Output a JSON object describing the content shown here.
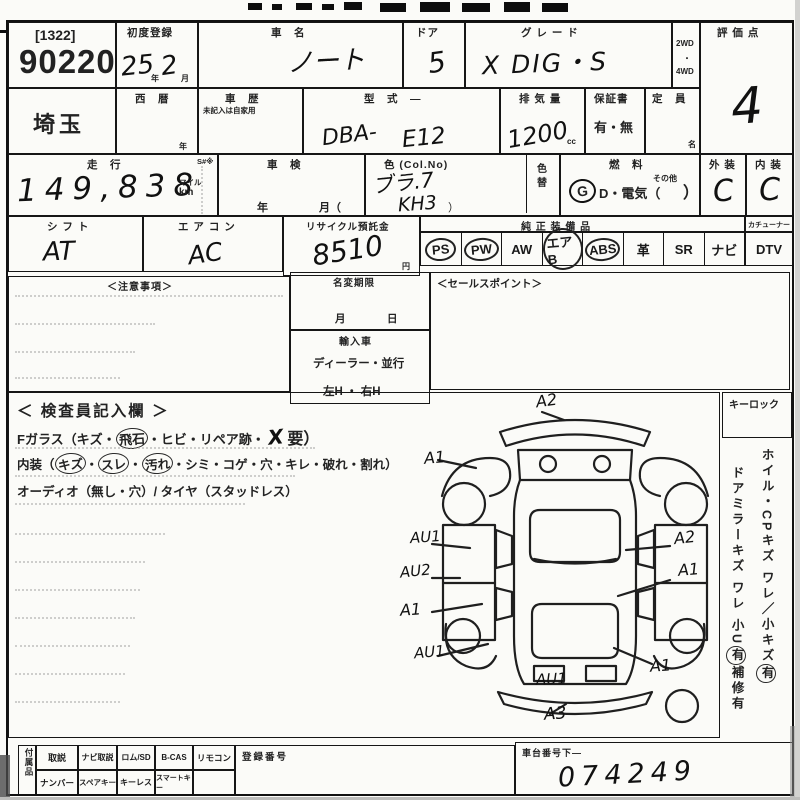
{
  "lot": {
    "bracket": "[1322]",
    "number": "90220",
    "prefecture": "埼玉"
  },
  "reg": {
    "label": "初度登録",
    "year": "25",
    "year_unit": "年",
    "month": "2",
    "month_unit": "月"
  },
  "car": {
    "name_label": "車　名",
    "name": "ノート",
    "door_label": "ドア",
    "door": "5",
    "grade_label": "グ レ ー ド",
    "grade": "X DIG・S"
  },
  "drive": {
    "top": "2WD",
    "mid": "・",
    "bottom": "4WD"
  },
  "score": {
    "label": "評 価 点",
    "value": "4"
  },
  "row2": {
    "seireki": "西　暦",
    "year_unit": "年",
    "shareki": "車　歴",
    "shareki_note": "未記入は自家用",
    "katashiki_label": "型　式　—",
    "katashiki_pre": "DBA-",
    "katashiki": "E12",
    "haiki_label": "排 気 量",
    "haiki": "1200",
    "cc": "cc",
    "hosho_label": "保証書",
    "hosho": "有・無",
    "teiin_label": "定　員",
    "mei": "名"
  },
  "row3": {
    "soko_label": "走　行",
    "soko": "149,838",
    "mairu": "マイル",
    "km": "km",
    "s_mark": "S#※",
    "shaken_label": "車　検",
    "nen": "年",
    "tsuki": "月（",
    "color_label": "色 (Col.No)",
    "color1": "ブラ.7",
    "color2": "KH3",
    "paren": "）",
    "irogae": "色替",
    "fuel_label": "燃　料",
    "g": "G",
    "fuel_mid": "D・電気（",
    "sonota": "その他",
    "close": "）",
    "ext_label": "外 装",
    "ext": "C",
    "int_label": "内 装",
    "int": "C"
  },
  "row4": {
    "shift_label": "シ フ ト",
    "shift": "AT",
    "ac_label": "エ ア コ ン",
    "ac": "AC",
    "recycle_label": "リサイクル預託金",
    "recycle": "8510",
    "yen": "円",
    "equip_label": "純 正 装 備 品",
    "tuner": "カチューナー",
    "items": [
      "PS",
      "PW",
      "AW",
      "エアB",
      "ABS",
      "革",
      "SR",
      "ナビ"
    ],
    "dtv": "DTV"
  },
  "mid": {
    "notes": "＜注意事項＞",
    "meihen": "名変期限",
    "m": "月",
    "d": "日",
    "import": "輸入車",
    "dealer": "ディーラー・並行",
    "handle": "左H ・ 右H",
    "sales": "＜セールスポイント＞"
  },
  "insp": {
    "title": "＜ 検査員記入欄 ＞",
    "f1a": "Fガラス（キズ・",
    "f1c": "飛石",
    "f1b": "・ヒビ・リペア跡・",
    "f1x": "X",
    "f1d": "要）",
    "n1": "内装（",
    "nc1": "キズ",
    "dot1": "・",
    "nc2": "スレ",
    "dot2": "・",
    "nc3": "汚れ",
    "n2": "・シミ・コゲ・穴・キレ・破れ・割れ）",
    "audio": "オーディオ（無し・穴）/ タイヤ（スタッドレス）",
    "keylock": "キーロック",
    "side1": "ホイル・CPキズ ワレ／小キズ",
    "side1c": "有",
    "side2": "ドアミラーキズ ワレ 小U",
    "side2c": "有",
    "side2b": "補修有",
    "marks": [
      "A2",
      "A1",
      "AU1",
      "AU2",
      "A1",
      "AU1",
      "AU1",
      "A3",
      "A2",
      "A1",
      "A1"
    ]
  },
  "bottom": {
    "group": "付属品",
    "r1": [
      "取説",
      "ナビ取説",
      "ロム/SD",
      "B-CAS",
      "リモコン"
    ],
    "r2": [
      "ナンバー",
      "スペアキー",
      "キーレス",
      "スマートキー"
    ],
    "regno": "登録番号",
    "chassis_label": "車台番号下—",
    "chassis": "074249"
  }
}
